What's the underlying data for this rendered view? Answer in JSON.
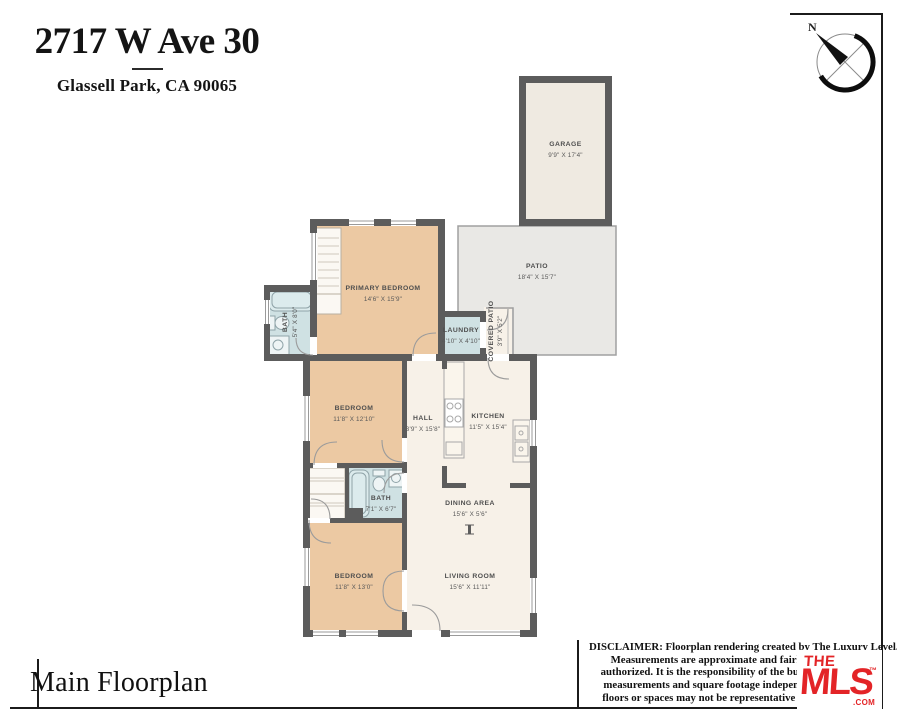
{
  "header": {
    "address": "2717 W Ave 30",
    "city_line": "Glassell Park, CA 90065"
  },
  "compass": {
    "north_label": "N"
  },
  "floorplan": {
    "rooms": {
      "garage": {
        "name": "GARAGE",
        "dims": "9'9\" X 17'4\""
      },
      "patio": {
        "name": "PATIO",
        "dims": "18'4\" X 15'7\""
      },
      "primary_bedroom": {
        "name": "PRIMARY BEDROOM",
        "dims": "14'6\" X 15'9\""
      },
      "bath_primary": {
        "name": "BATH",
        "dims": "5'4\" X 8'0\""
      },
      "laundry": {
        "name": "LAUNDRY",
        "dims": "4'10\" X 4'10\""
      },
      "covered_patio": {
        "name": "COVERED PATIO",
        "dims": "3'9\" X 5'2\""
      },
      "bedroom_middle": {
        "name": "BEDROOM",
        "dims": "11'8\" X 12'10\""
      },
      "hall": {
        "name": "HALL",
        "dims": "3'9\" X 15'8\""
      },
      "kitchen": {
        "name": "KITCHEN",
        "dims": "11'5\" X 15'4\""
      },
      "bath_hall": {
        "name": "BATH",
        "dims": "7'1\" X 6'7\""
      },
      "dining_area": {
        "name": "DINING AREA",
        "dims": "15'6\" X 5'6\""
      },
      "bedroom_front": {
        "name": "BEDROOM",
        "dims": "11'8\" X 13'0\""
      },
      "living_room": {
        "name": "LIVING ROOM",
        "dims": "15'6\" X 11'11\""
      }
    }
  },
  "footer": {
    "plan_label": "Main Floorplan",
    "disclaimer_lines": [
      "DISCLAIMER: Floorplan rendering created by The Luxury Level.",
      "Measurements are approximate and fairly exact but r",
      "authorized. It is the responsibility of the buyer to verify th",
      "measurements and square footage independently. Multip",
      "floors or spaces may not be representative of actual locati"
    ]
  },
  "logo": {
    "the": "THE",
    "mls": "MLS",
    "tm": "™",
    "com": ".COM"
  },
  "colors": {
    "bedroom_fill": "#ecc9a3",
    "bath_fill": "#cfe1e3",
    "living_fill": "#f7f1e8",
    "patio_fill": "#e9e8e5",
    "garage_fill": "#efeae1",
    "closet_fill": "#fbf8f3",
    "wall": "#5c5c5c",
    "logo_red": "#e32427"
  }
}
